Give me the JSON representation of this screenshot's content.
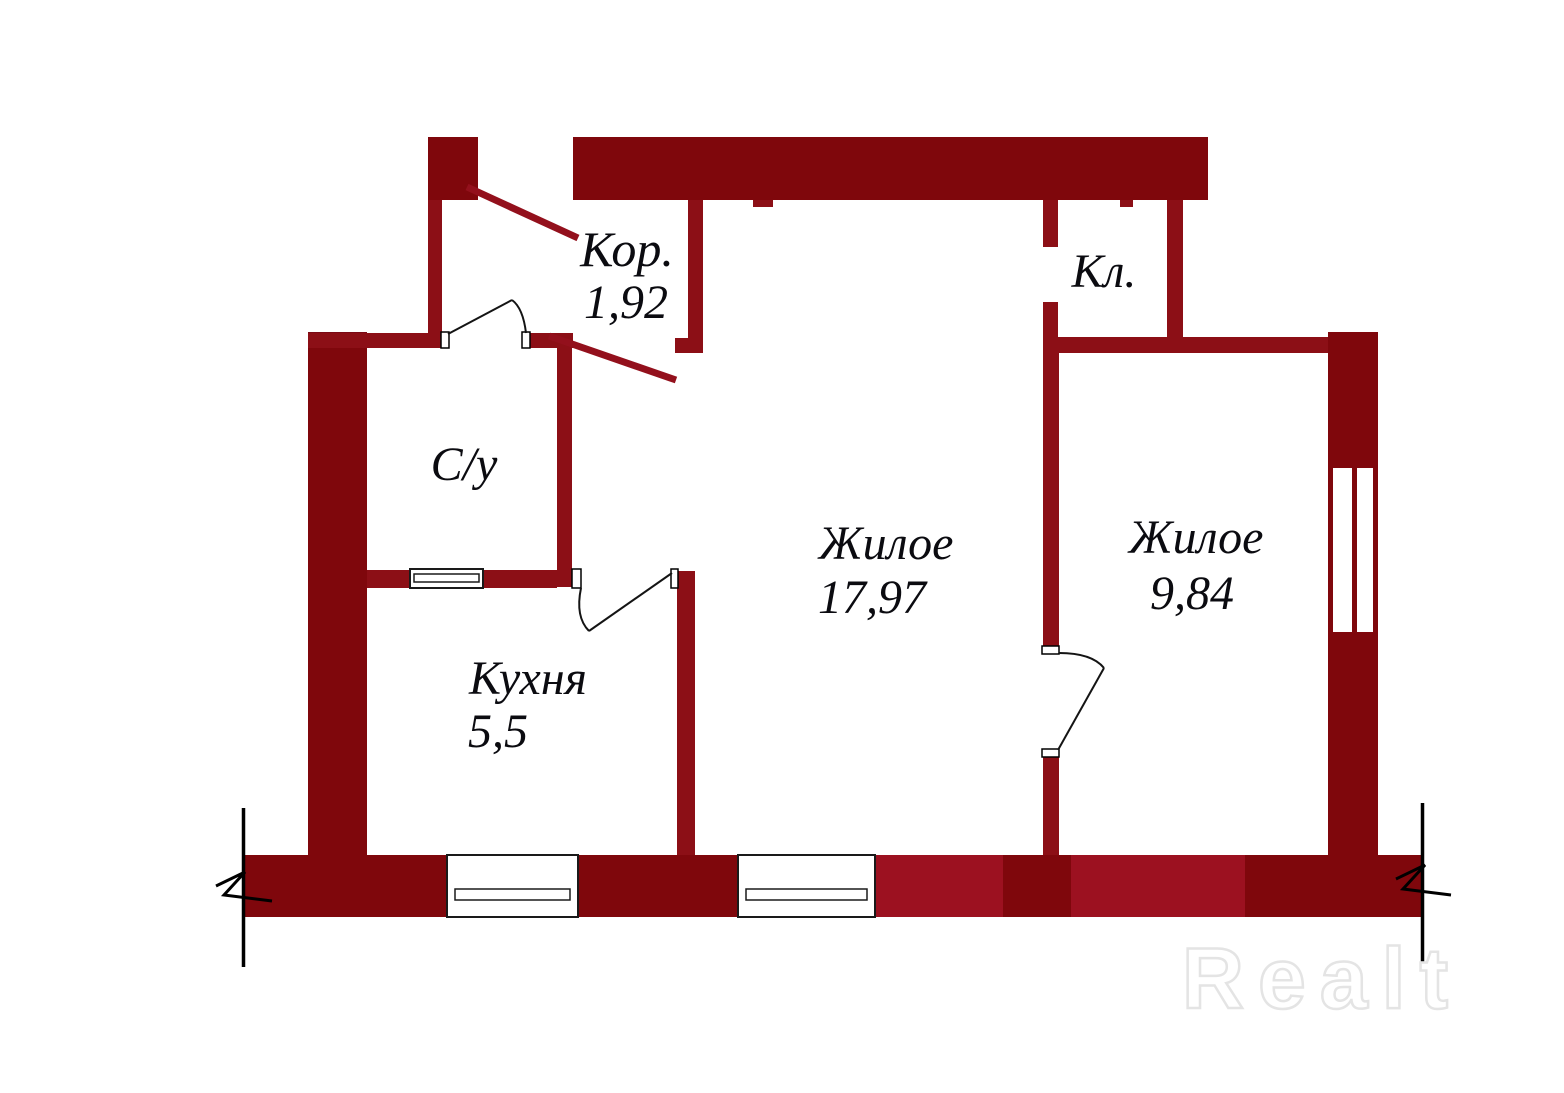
{
  "plan": {
    "type": "apartment-floor-plan",
    "rooms": [
      {
        "id": "corridor",
        "label": "Кор.",
        "area": "1,92"
      },
      {
        "id": "closet",
        "label": "Кл."
      },
      {
        "id": "bathroom",
        "label": "С/у"
      },
      {
        "id": "kitchen",
        "label": "Кухня",
        "area": "5,5"
      },
      {
        "id": "living-large",
        "label": "Жилое",
        "area": "17,97"
      },
      {
        "id": "living-small",
        "label": "Жилое",
        "area": "9,84"
      }
    ],
    "colors": {
      "wall_dark": "#7F070C",
      "wall_partition": "#8C0F16",
      "wall_bright": "#9C1120",
      "pointer_line": "#93101C",
      "label_text": "#0b0b10",
      "door_line": "#141414",
      "watermark_stroke": "#e4e4e4"
    }
  },
  "watermark": {
    "text": "Realt"
  }
}
